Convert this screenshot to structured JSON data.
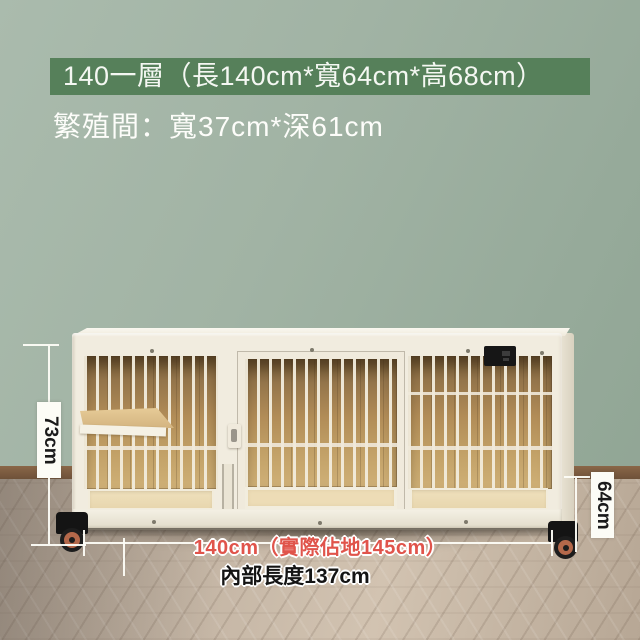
{
  "banner": {
    "title": "140一層（長140cm*寬64cm*高68cm）",
    "bg_color": "#56805a",
    "text_color": "#f4f7f2"
  },
  "subtitle": {
    "text": "繁殖間：寬37cm*深61cm",
    "text_color": "#fdfdfa"
  },
  "dimensions": {
    "left_height": "73cm",
    "right_height": "64cm",
    "floor_width": "140cm（實際佔地145cm）",
    "inner_length": "內部長度137cm",
    "floor_width_color": "#e0544b"
  },
  "scene": {
    "wall_color": "#9fb2a3",
    "baseboard_color": "#7c5b42",
    "floor_color": "#c0b0a0",
    "cage_frame_color": "#f1ecdf",
    "cage_wood_color": "#b18c57",
    "caster_wheel_color": "#b4684a"
  }
}
